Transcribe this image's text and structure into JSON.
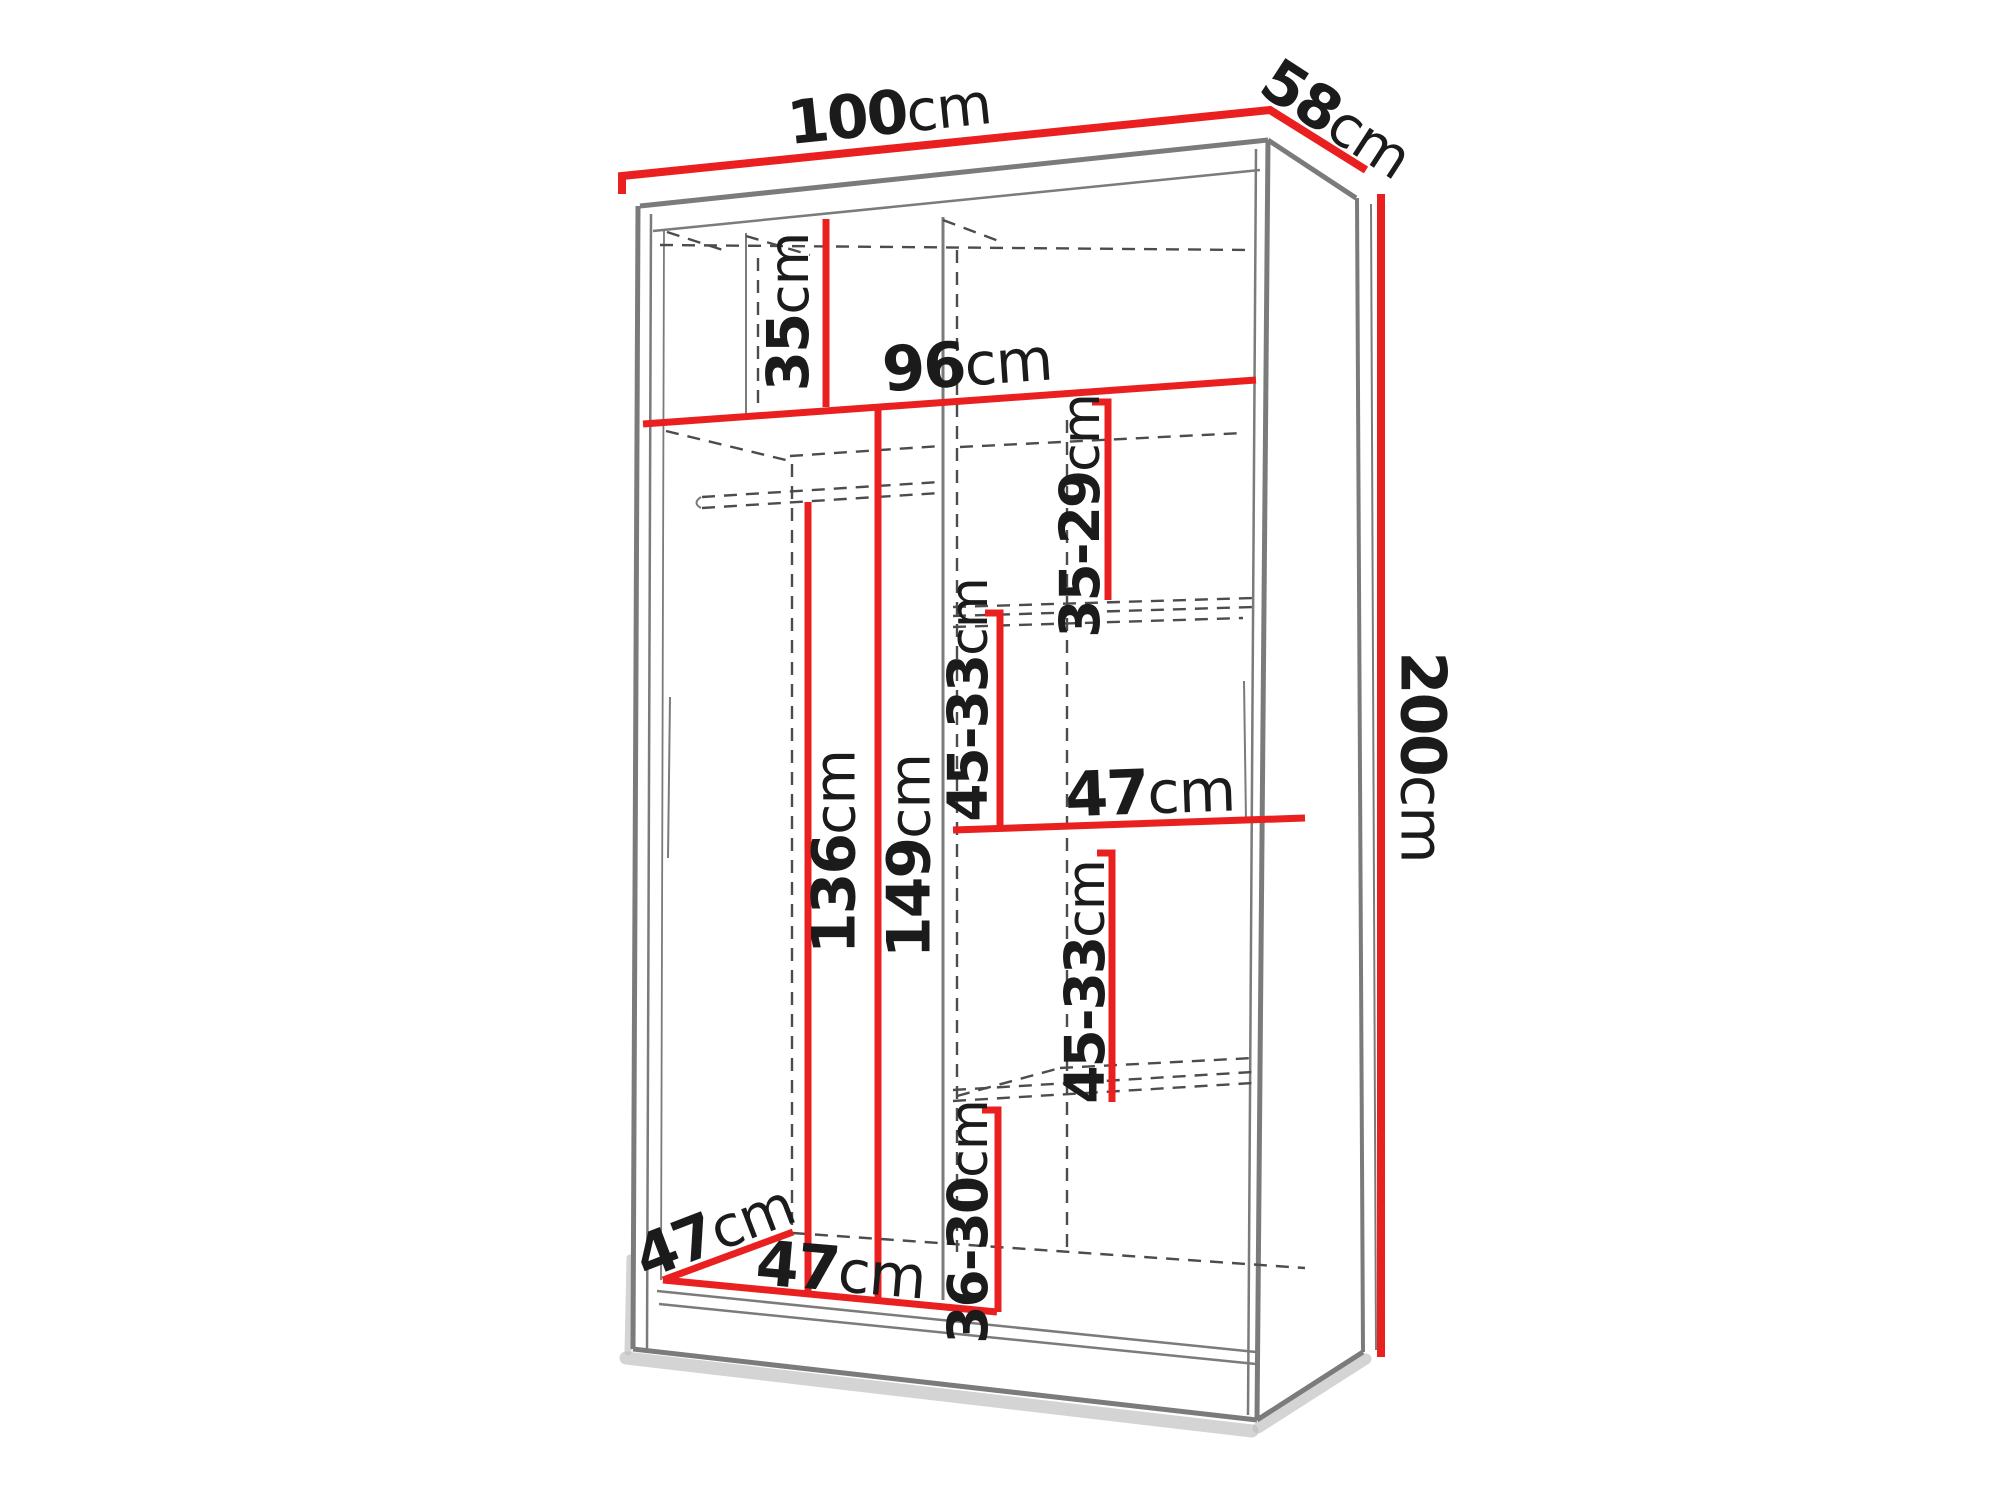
{
  "diagram": {
    "unit": "cm",
    "colors": {
      "dimension_line": "#e9201f",
      "structure_line": "#7b7b7b",
      "dashed_line": "#4c4c4c",
      "label_text": "#1b1b1b",
      "background": "#ffffff"
    },
    "labels": {
      "width_top": {
        "num": "100",
        "unit": "cm"
      },
      "depth_top": {
        "num": "58",
        "unit": "cm"
      },
      "height_right": {
        "num": "200",
        "unit": "cm"
      },
      "top_shelf_height": {
        "num": "35",
        "unit": "cm"
      },
      "interior_width": {
        "num": "96",
        "unit": "cm"
      },
      "right_gap_top": {
        "num": "35-29",
        "unit": "cm"
      },
      "right_gap_upper": {
        "num": "45-33",
        "unit": "cm"
      },
      "middle_shelf_width": {
        "num": "47",
        "unit": "cm"
      },
      "right_gap_lower": {
        "num": "45-33",
        "unit": "cm"
      },
      "hanging_height_left": {
        "num": "136",
        "unit": "cm"
      },
      "hanging_height_right": {
        "num": "149",
        "unit": "cm"
      },
      "bottom_depth": {
        "num": "47",
        "unit": "cm"
      },
      "bottom_width": {
        "num": "47",
        "unit": "cm"
      },
      "right_gap_bottom": {
        "num": "36-30",
        "unit": "cm"
      }
    }
  }
}
